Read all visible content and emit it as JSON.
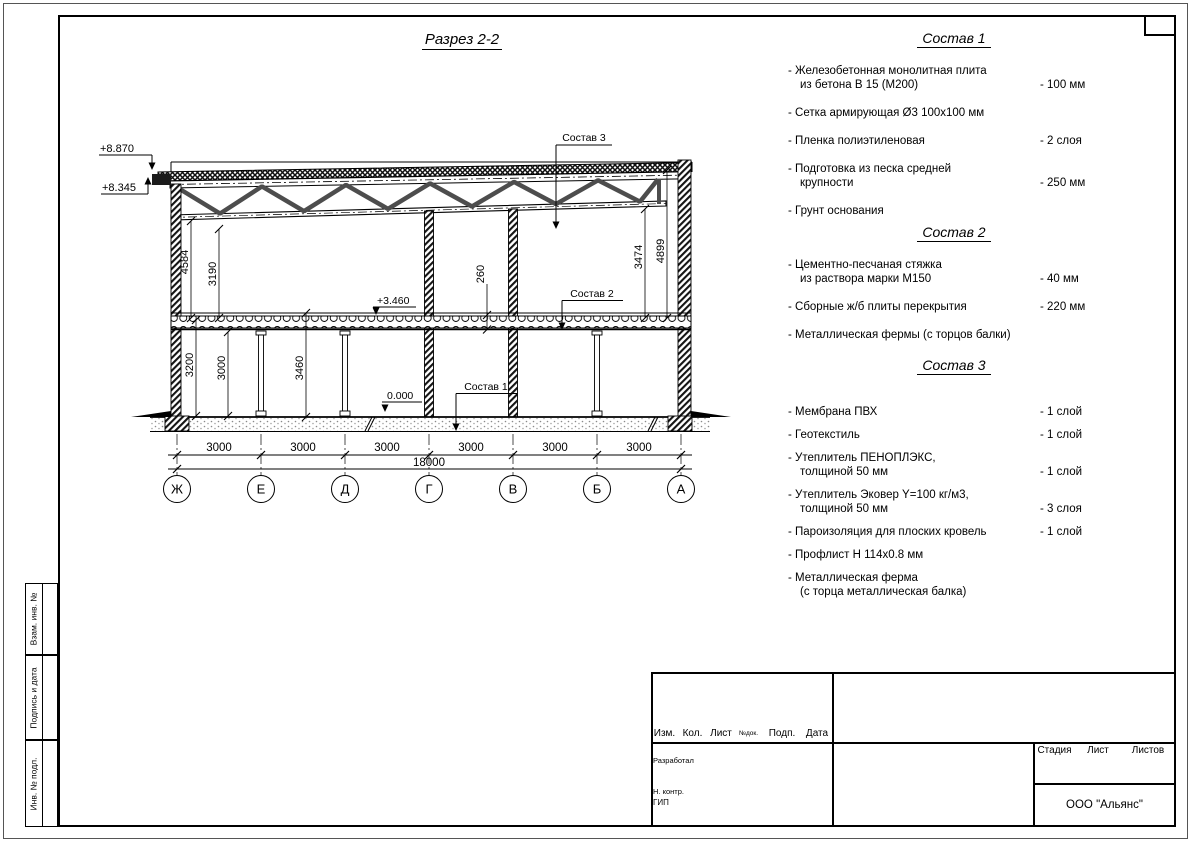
{
  "drawing": {
    "title": "Разрез 2-2",
    "elevations": {
      "parapet": "+8.870",
      "eave": "+8.345",
      "floor2": "+3.460",
      "ground": "0.000"
    },
    "leaders": [
      "Состав 1",
      "Состав 2",
      "Состав 3"
    ],
    "vdims": {
      "h4584": "4584",
      "h3190": "3190",
      "h260": "260",
      "h3474": "3474",
      "h4899": "4899",
      "h3200": "3200",
      "h3000": "3000",
      "h3460": "3460"
    },
    "spans": [
      "3000",
      "3000",
      "3000",
      "3000",
      "3000",
      "3000"
    ],
    "total_span": "18000",
    "axes": [
      "Ж",
      "Е",
      "Д",
      "Г",
      "В",
      "Б",
      "А"
    ]
  },
  "compositions": [
    {
      "title": "Состав 1",
      "items": [
        {
          "l1": "- Железобетонная  монолитная плита",
          "l2": "из бетона В 15 (М200)",
          "v": "- 100 мм"
        },
        {
          "l1": "- Сетка армирующая Ø3 100х100 мм",
          "l2": "",
          "v": ""
        },
        {
          "l1": "- Пленка полиэтиленовая",
          "l2": "",
          "v": "-  2 слоя"
        },
        {
          "l1": "- Подготовка из песка средней",
          "l2": "крупности",
          "v": "- 250 мм"
        },
        {
          "l1": "- Грунт основания",
          "l2": "",
          "v": ""
        }
      ]
    },
    {
      "title": "Состав 2",
      "items": [
        {
          "l1": "- Цементно-песчаная стяжка",
          "l2": "из раствора марки М150",
          "v": "- 40 мм"
        },
        {
          "l1": "- Сборные ж/б плиты перекрытия",
          "l2": "",
          "v": "- 220 мм"
        },
        {
          "l1": "- Металлическая фермы (с торцов балки)",
          "l2": "",
          "v": ""
        }
      ]
    },
    {
      "title": "Состав 3",
      "items": [
        {
          "l1": "- Мембрана ПВХ",
          "l2": "",
          "v": "- 1 слой"
        },
        {
          "l1": "- Геотекстиль",
          "l2": "",
          "v": "- 1 слой"
        },
        {
          "l1": "- Утеплитель ПЕНОПЛЭКС,",
          "l2": "толщиной 50 мм",
          "v": "- 1 слой"
        },
        {
          "l1": "- Утеплитель Эковер Y=100 кг/м3,",
          "l2": "толщиной 50 мм",
          "v": "- 3 слоя"
        },
        {
          "l1": "- Пароизоляция для плоских кровель",
          "l2": "",
          "v": "- 1 слой"
        },
        {
          "l1": "- Профлист Н 114х0.8 мм",
          "l2": "",
          "v": ""
        },
        {
          "l1": "- Металлическая ферма",
          "l2": "(с торца металлическая балка)",
          "v": ""
        }
      ]
    }
  ],
  "side_strip": [
    "Взам. инв. №",
    "Подпись и дата",
    "Инв. № подл."
  ],
  "title_block": {
    "rev_cols": [
      "Изм.",
      "Кол.",
      "Лист",
      "№док.",
      "Подп.",
      "Дата"
    ],
    "roles": [
      "Разработал",
      "Н. контр.",
      "ГИП"
    ],
    "stage_cols": [
      "Стадия",
      "Лист",
      "Листов"
    ],
    "company": "ООО \"Альянс\""
  }
}
